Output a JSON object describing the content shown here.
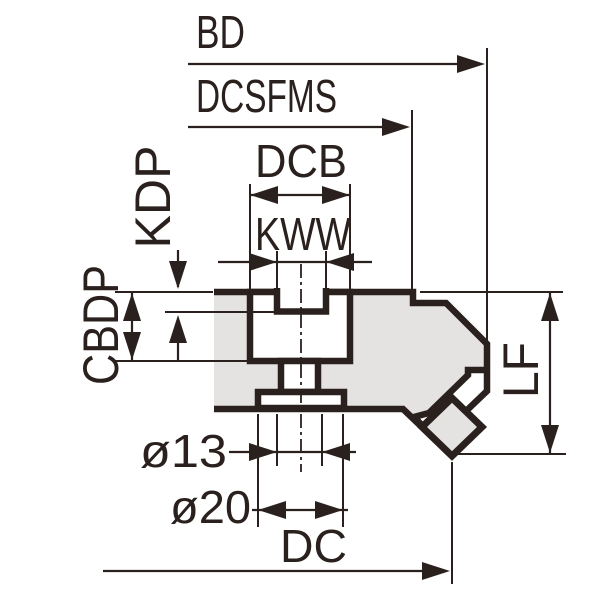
{
  "drawing": {
    "type": "technical-dimension-drawing",
    "subject": "milling cutter body cross-section with dimension callouts",
    "labels": {
      "bd": "BD",
      "dcsfms": "DCSFMS",
      "dcb": "DCB",
      "kww": "KWW",
      "kdp": "KDP",
      "cbdp": "CBDP",
      "lf": "LF",
      "bore": "ø13",
      "counterbore": "ø20",
      "dc": "DC"
    },
    "colors": {
      "ink": "#2a211e",
      "body_fill": "#e4e3e2",
      "background": "#ffffff"
    }
  }
}
